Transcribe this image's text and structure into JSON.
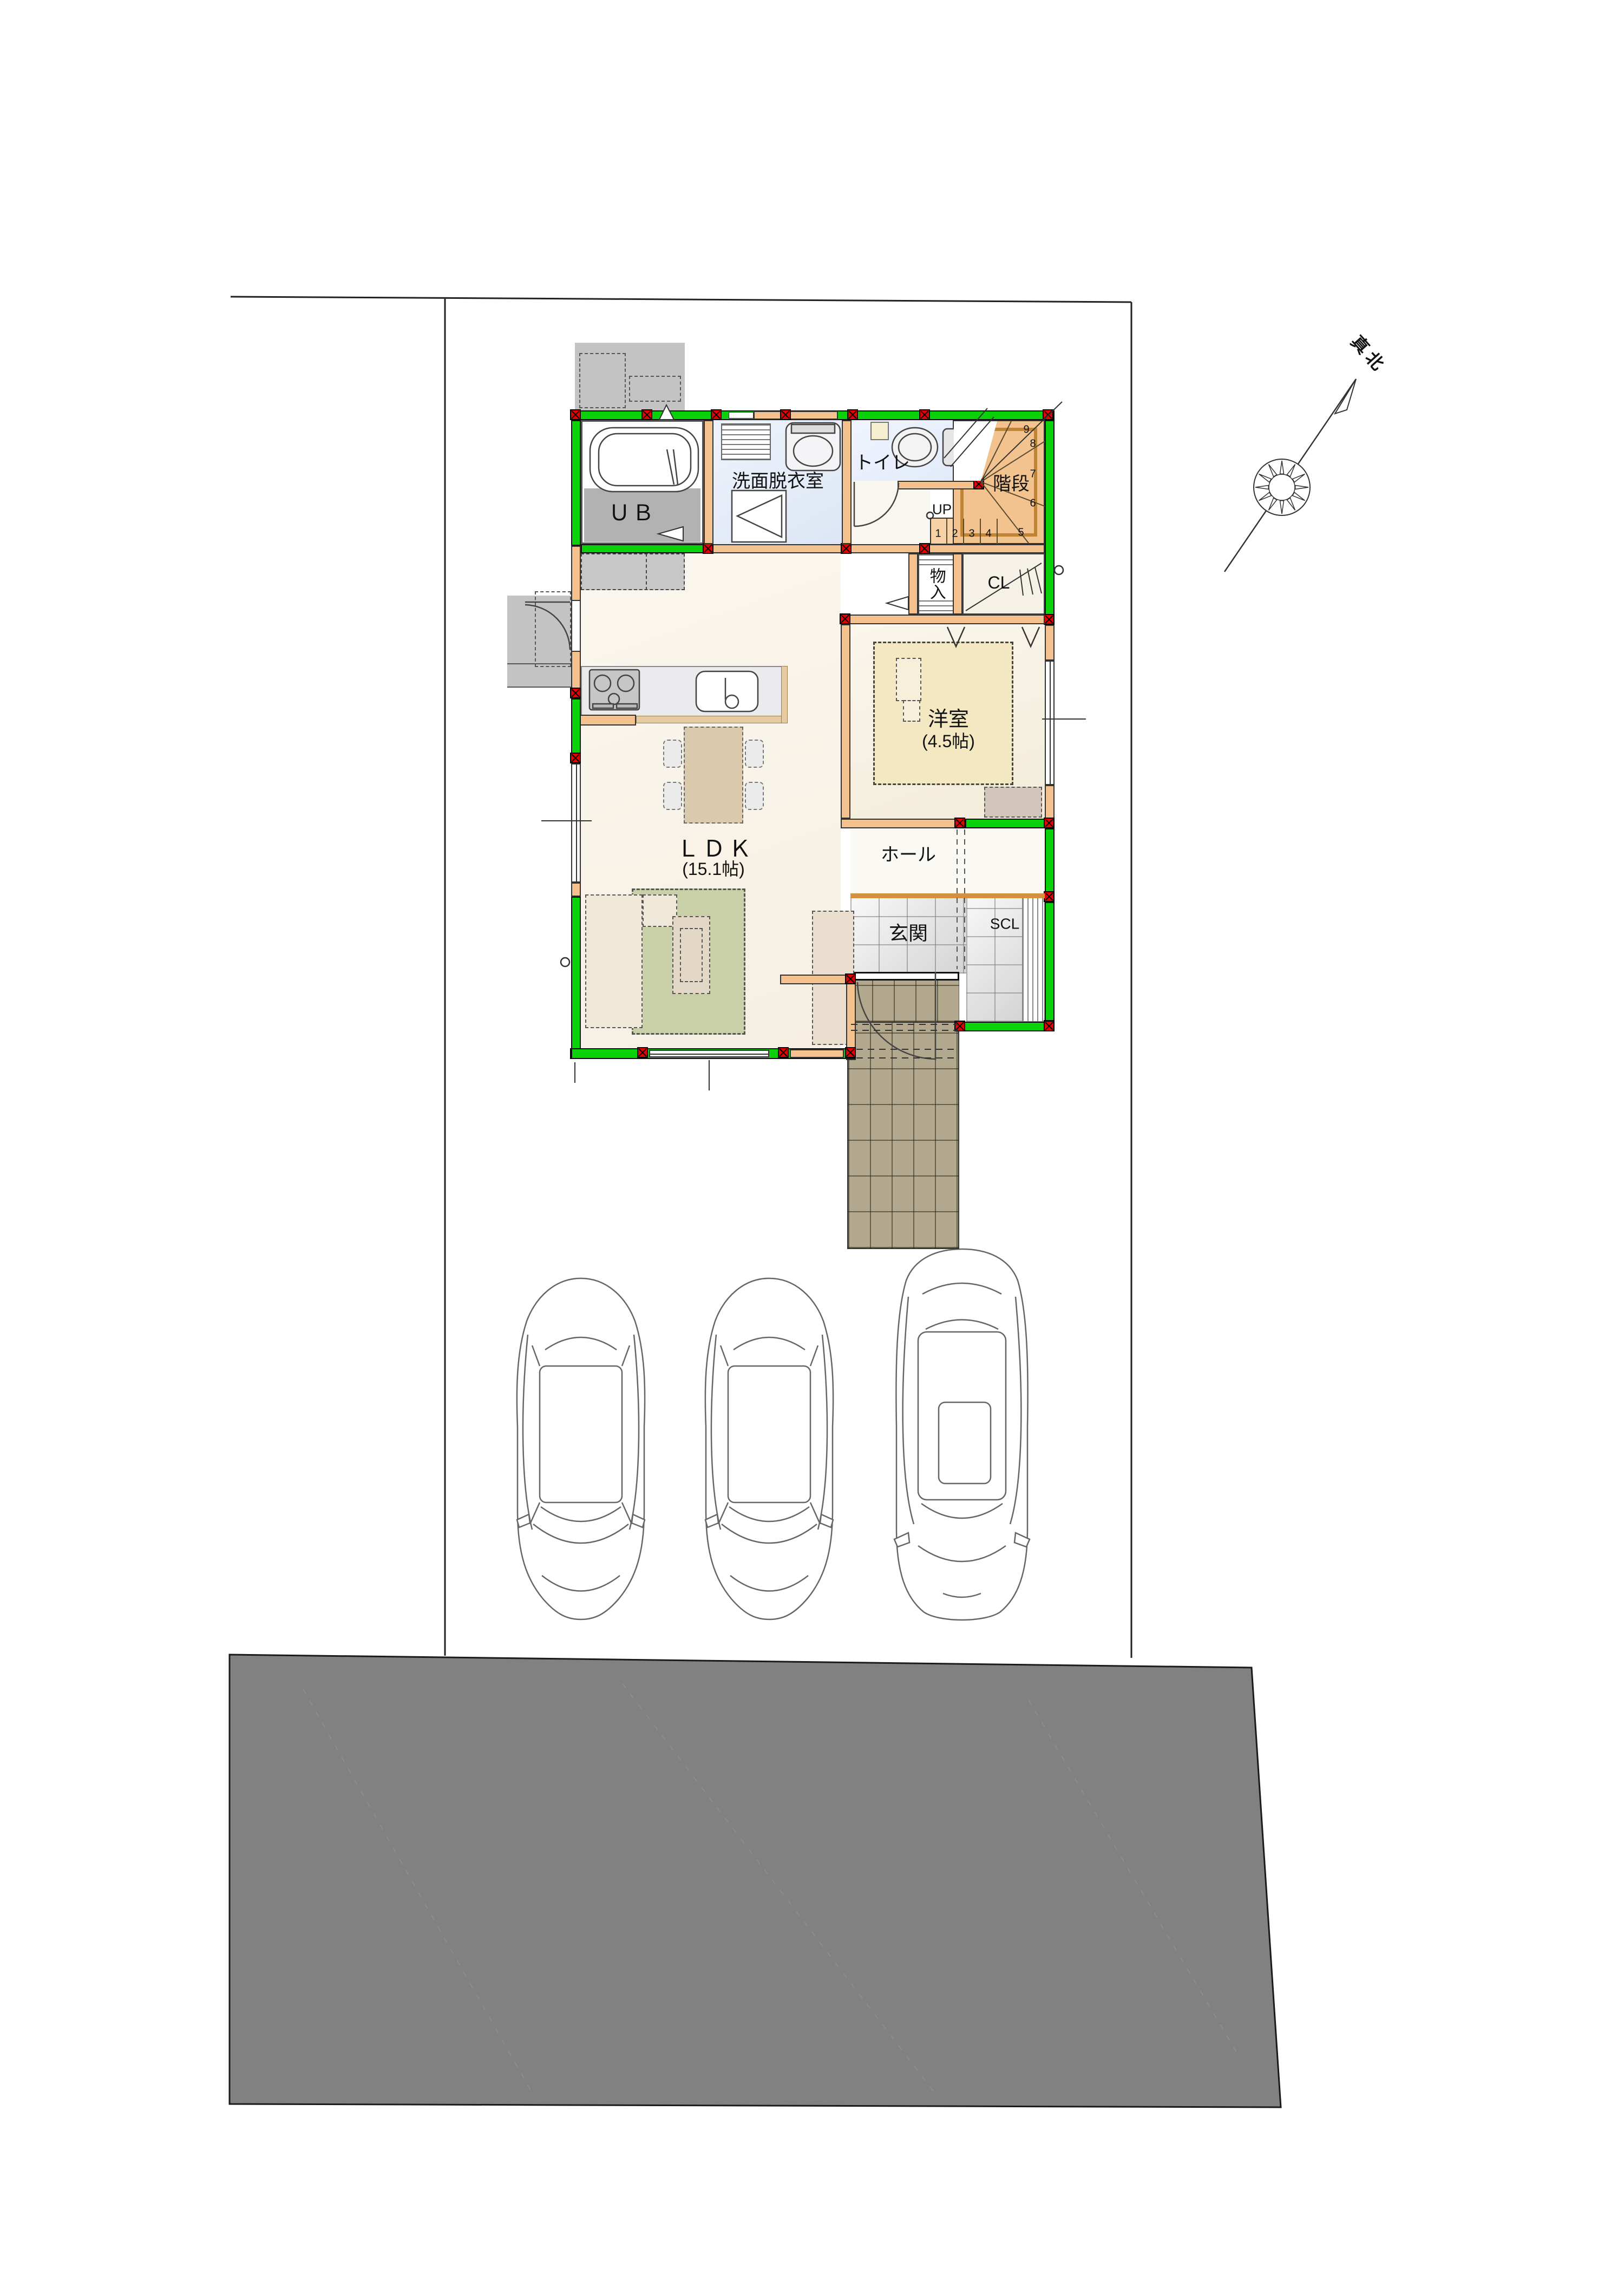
{
  "site": {
    "north_label": "真北",
    "road_color": "#818181",
    "boundary_color": "#222222",
    "parking_car_count": 3
  },
  "plan": {
    "rooms": {
      "ub": {
        "label": "ＵＢ"
      },
      "washroom": {
        "label": "洗面脱衣室"
      },
      "toilet": {
        "label": "トイレ"
      },
      "stairs": {
        "label": "階段",
        "up_label": "UP"
      },
      "storage": {
        "label": "物入"
      },
      "closet": {
        "label": "CL"
      },
      "western_room": {
        "label": "洋室",
        "size": "(4.5帖)"
      },
      "hall": {
        "label": "ホール"
      },
      "entrance": {
        "label": "玄関"
      },
      "shoe_closet": {
        "label": "SCL"
      },
      "ldk": {
        "label": "ＬＤＫ",
        "size": "(15.1帖)"
      }
    },
    "stair_numbers": [
      "1",
      "2",
      "3",
      "4",
      "5",
      "6",
      "7",
      "8",
      "9"
    ],
    "colors": {
      "wall_insulated": "#0ad10a",
      "wall_wood": "#f4c28e",
      "column_marker": "#e80000",
      "stairs_fill": "#f3c38f",
      "western_rug": "#f4e8c2",
      "ldk_rug": "#c9cfa7",
      "porch_tile": "#b1a88e"
    }
  }
}
